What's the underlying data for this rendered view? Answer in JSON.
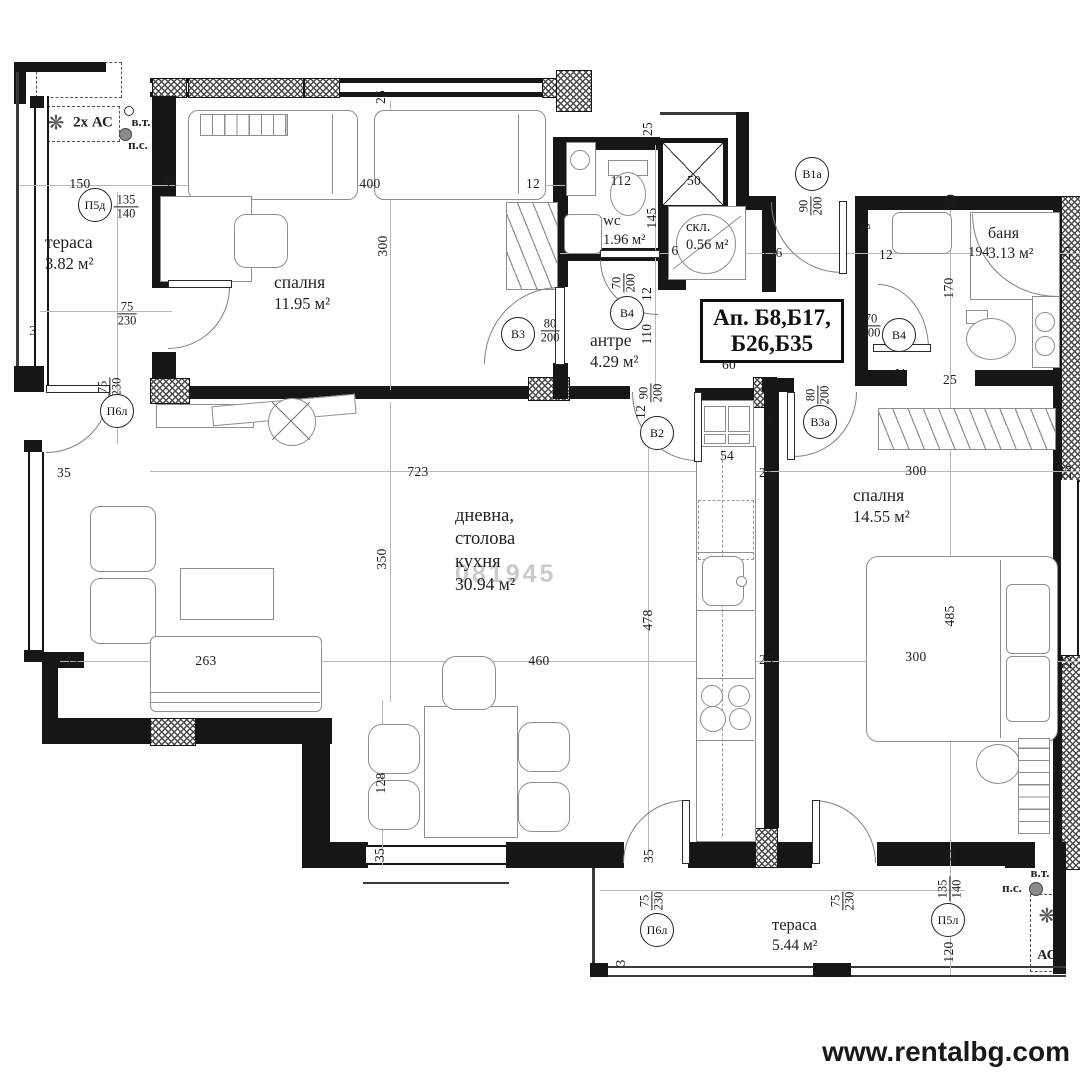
{
  "watermark": {
    "site": "www.rentalbg.com",
    "overlay": "081945"
  },
  "apartment_box": {
    "line1": "Ап. Б8,Б17,",
    "line2": "Б26,Б35"
  },
  "ac": {
    "top_left_label": "2х АС",
    "bottom_right_label": "АС",
    "vt": "в.т.",
    "ps": "п.с."
  },
  "icons": {
    "fan": "❋",
    "snowflake": "❆"
  },
  "rooms": {
    "terasa1": {
      "name": "тераса",
      "area": "3.82 м²"
    },
    "spalnya1": {
      "name": "спалня",
      "area": "11.95 м²"
    },
    "wc": {
      "name": "wc",
      "area": "1.96 м²"
    },
    "skl": {
      "name": "скл.",
      "area": "0.56 м²"
    },
    "antre": {
      "name": "антре",
      "area": "4.29 м²"
    },
    "banya": {
      "name": "баня",
      "area": "3.13 м²"
    },
    "dnevna": {
      "name_line1": "дневна,",
      "name_line2": "столова",
      "name_line3": "кухня",
      "area": "30.94 м²"
    },
    "spalnya2": {
      "name": "спалня",
      "area": "14.55 м²"
    },
    "terasa2": {
      "name": "тераса",
      "area": "5.44 м²"
    }
  },
  "plan": {
    "door_markers": [
      {
        "label": "П5д",
        "x": 95,
        "y": 205
      },
      {
        "label": "П6л",
        "x": 117,
        "y": 411
      },
      {
        "label": "В3",
        "x": 518,
        "y": 334
      },
      {
        "label": "В4",
        "x": 627,
        "y": 313
      },
      {
        "label": "В2",
        "x": 657,
        "y": 433
      },
      {
        "label": "В1а",
        "x": 812,
        "y": 174
      },
      {
        "label": "В3а",
        "x": 820,
        "y": 422
      },
      {
        "label": "В4",
        "x": 899,
        "y": 335
      },
      {
        "label": "П6л",
        "x": 657,
        "y": 930
      },
      {
        "label": "П5л",
        "x": 948,
        "y": 920
      }
    ],
    "fractions": [
      {
        "num": "135",
        "den": "140",
        "x": 126,
        "y": 207,
        "rot": 0
      },
      {
        "num": "75",
        "den": "230",
        "x": 127,
        "y": 314,
        "rot": 0
      },
      {
        "num": "75",
        "den": "230",
        "x": 110,
        "y": 387,
        "rot": 1
      },
      {
        "num": "80",
        "den": "200",
        "x": 550,
        "y": 331,
        "rot": 0
      },
      {
        "num": "70",
        "den": "200",
        "x": 624,
        "y": 283,
        "rot": 1
      },
      {
        "num": "90",
        "den": "200",
        "x": 811,
        "y": 206,
        "rot": 1
      },
      {
        "num": "90",
        "den": "200",
        "x": 651,
        "y": 393,
        "rot": 1
      },
      {
        "num": "80",
        "den": "200",
        "x": 818,
        "y": 395,
        "rot": 1
      },
      {
        "num": "70",
        "den": "200",
        "x": 871,
        "y": 326,
        "rot": 0
      },
      {
        "num": "75",
        "den": "230",
        "x": 652,
        "y": 901,
        "rot": 1
      },
      {
        "num": "75",
        "den": "230",
        "x": 843,
        "y": 901,
        "rot": 1
      },
      {
        "num": "135",
        "den": "140",
        "x": 950,
        "y": 889,
        "rot": 1
      }
    ],
    "dimensions": [
      {
        "t": "150",
        "x": 80,
        "y": 184
      },
      {
        "t": "35",
        "x": 170,
        "y": 184
      },
      {
        "t": "400",
        "x": 370,
        "y": 184
      },
      {
        "t": "12",
        "x": 533,
        "y": 184
      },
      {
        "t": "25",
        "x": 381,
        "y": 97,
        "rot": 1
      },
      {
        "t": "300",
        "x": 383,
        "y": 246,
        "rot": 1
      },
      {
        "t": "3",
        "x": 33,
        "y": 331
      },
      {
        "t": "112",
        "x": 621,
        "y": 181
      },
      {
        "t": "50",
        "x": 694,
        "y": 181
      },
      {
        "t": "25",
        "x": 648,
        "y": 129,
        "rot": 1
      },
      {
        "t": "145",
        "x": 652,
        "y": 218,
        "rot": 1
      },
      {
        "t": "12",
        "x": 647,
        "y": 294,
        "rot": 1
      },
      {
        "t": "110",
        "x": 647,
        "y": 334,
        "rot": 1
      },
      {
        "t": "6",
        "x": 675,
        "y": 251
      },
      {
        "t": "196",
        "x": 772,
        "y": 253
      },
      {
        "t": "60",
        "x": 729,
        "y": 365
      },
      {
        "t": "9",
        "x": 866,
        "y": 226,
        "rot": 1
      },
      {
        "t": "12",
        "x": 886,
        "y": 255
      },
      {
        "t": "194",
        "x": 979,
        "y": 252
      },
      {
        "t": "20",
        "x": 951,
        "y": 201,
        "rot": 1
      },
      {
        "t": "170",
        "x": 949,
        "y": 288,
        "rot": 1
      },
      {
        "t": "12",
        "x": 900,
        "y": 375,
        "rot": 1
      },
      {
        "t": "25",
        "x": 950,
        "y": 380
      },
      {
        "t": "25",
        "x": 1066,
        "y": 253,
        "rot": 1
      },
      {
        "t": "300",
        "x": 916,
        "y": 471
      },
      {
        "t": "25",
        "x": 1067,
        "y": 472,
        "rot": 1
      },
      {
        "t": "485",
        "x": 950,
        "y": 616,
        "rot": 1
      },
      {
        "t": "300",
        "x": 916,
        "y": 657
      },
      {
        "t": "25",
        "x": 1067,
        "y": 662,
        "rot": 1
      },
      {
        "t": "723",
        "x": 418,
        "y": 472
      },
      {
        "t": "350",
        "x": 382,
        "y": 559,
        "rot": 1
      },
      {
        "t": "478",
        "x": 648,
        "y": 620,
        "rot": 1
      },
      {
        "t": "460",
        "x": 539,
        "y": 661
      },
      {
        "t": "54",
        "x": 727,
        "y": 456
      },
      {
        "t": "6",
        "x": 770,
        "y": 422
      },
      {
        "t": "25",
        "x": 766,
        "y": 473
      },
      {
        "t": "25",
        "x": 766,
        "y": 660
      },
      {
        "t": "263",
        "x": 206,
        "y": 661
      },
      {
        "t": "128",
        "x": 381,
        "y": 783,
        "rot": 1
      },
      {
        "t": "35",
        "x": 380,
        "y": 855,
        "rot": 1
      },
      {
        "t": "25",
        "x": 72,
        "y": 662
      },
      {
        "t": "35",
        "x": 64,
        "y": 473
      },
      {
        "t": "35",
        "x": 649,
        "y": 856,
        "rot": 1
      },
      {
        "t": "3",
        "x": 621,
        "y": 963,
        "rot": 1
      },
      {
        "t": "35",
        "x": 951,
        "y": 856,
        "rot": 1
      },
      {
        "t": "120",
        "x": 949,
        "y": 952,
        "rot": 1
      },
      {
        "t": "12",
        "x": 641,
        "y": 412,
        "rot": 1
      }
    ]
  }
}
